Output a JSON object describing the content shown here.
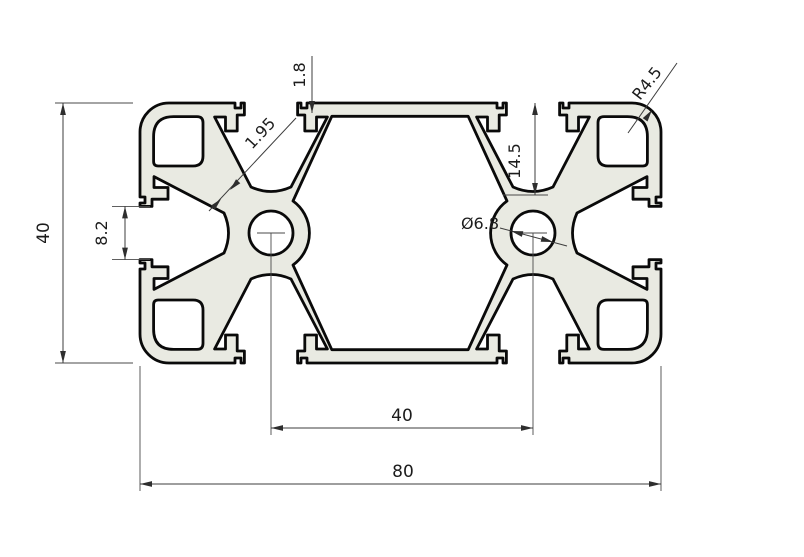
{
  "drawing": {
    "type": "profile-cross-section",
    "colors": {
      "background": "#ffffff",
      "metal_fill": "#e9eae2",
      "outline": "#0a0a0a",
      "dimension_lines": "#3c3c3c",
      "text": "#1c1c1c"
    },
    "dimensions": {
      "overall_height": "40",
      "overall_width": "80",
      "hole_spacing": "40",
      "end_slot_opening": "8.2",
      "slot_depth": "14.5",
      "slot_lip_thickness": "1.8",
      "web_wall_thickness": "1.95",
      "center_hole_diameter": "Ø6.8",
      "corner_radius": "R4.5"
    }
  }
}
